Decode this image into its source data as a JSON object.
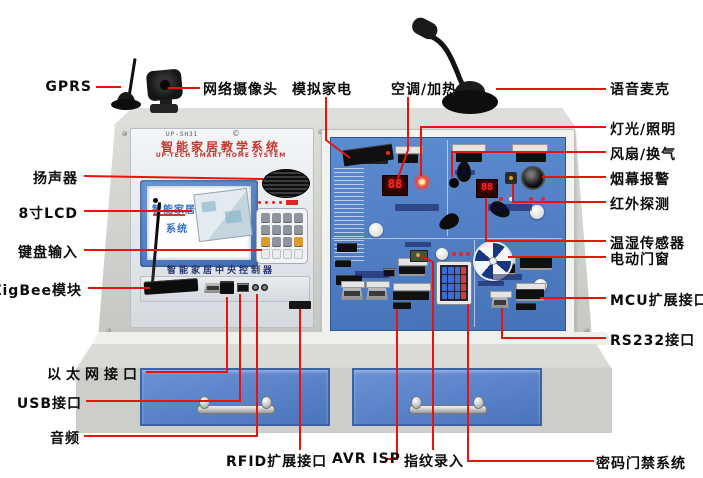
{
  "device": {
    "model": "UP-SH31",
    "copyright": "©",
    "title_cn": "智能家居教学系统",
    "title_en": "UP-TECH SMART HOME SYSTEM",
    "lcd_line1": "智能家居",
    "lcd_line2": "系统",
    "controller_label": "智能家居中央控制器",
    "temp_display": "88",
    "env_display": "88"
  },
  "colors": {
    "callout_line": "#e8140c",
    "panel_blue": "#4f7fc6",
    "drawer_blue": "#5b82c8",
    "title_red": "#c5372c",
    "seg_red": "#ff2318"
  },
  "callouts": {
    "gprs": {
      "label": "GPRS"
    },
    "camera": {
      "label": "网络摄像头"
    },
    "appliance": {
      "label": "模拟家电"
    },
    "aircon": {
      "label": "空调/加热"
    },
    "mic": {
      "label": "语音麦克"
    },
    "speaker": {
      "label": "扬声器"
    },
    "lcd": {
      "label": "8寸LCD"
    },
    "keyinput": {
      "label": "键盘输入"
    },
    "zigbee": {
      "label": "ZigBee模块"
    },
    "ethernet": {
      "label": "以太网接口"
    },
    "usb": {
      "label": "USB接口"
    },
    "audio": {
      "label": "音频"
    },
    "light": {
      "label": "灯光/照明"
    },
    "fan": {
      "label": "风扇/换气"
    },
    "smoke": {
      "label": "烟幕报警"
    },
    "infrared": {
      "label": "红外探测"
    },
    "temphum": {
      "label": "温湿传感器"
    },
    "window": {
      "label": "电动门窗"
    },
    "mcu": {
      "label": "MCU扩展接口"
    },
    "rs232": {
      "label": "RS232接口"
    },
    "rfid": {
      "label": "RFID扩展接口"
    },
    "avrisp": {
      "label": "AVR ISP"
    },
    "fingerprint": {
      "label": "指纹录入"
    },
    "doorlock": {
      "label": "密码门禁系统"
    }
  }
}
